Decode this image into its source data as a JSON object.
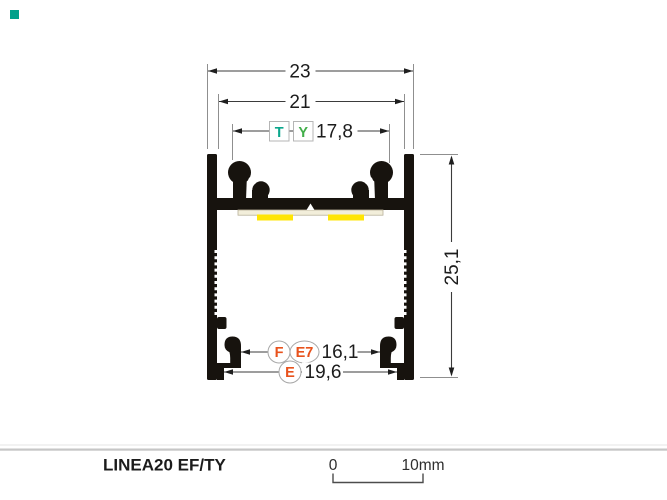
{
  "page": {
    "background": "#ffffff"
  },
  "color_swatch": {
    "color": "#00a18b"
  },
  "drawing": {
    "dimensions": {
      "outer_width": "23",
      "inner_width": "21",
      "cover_width": "17,8",
      "height": "25,1",
      "hook_spacing": "16,1",
      "foot_spacing": "19,6"
    },
    "cover_labels": [
      {
        "id": "T",
        "color": "#0ba78d"
      },
      {
        "id": "Y",
        "color": "#41ae49"
      }
    ],
    "accessory_labels": [
      {
        "id": "F"
      },
      {
        "id": "E7"
      },
      {
        "id": "E"
      }
    ],
    "accessory_color": "#e8521c",
    "colors": {
      "profile": "#17130e",
      "pcb": "#f2eeda",
      "led": "#ffe504",
      "dimension_line": "#3b3b3b",
      "extension_line": "#8f8f8f"
    }
  },
  "footer": {
    "product_name": "LINEA20 EF/TY",
    "scale_start": "0",
    "scale_end": "10mm"
  }
}
